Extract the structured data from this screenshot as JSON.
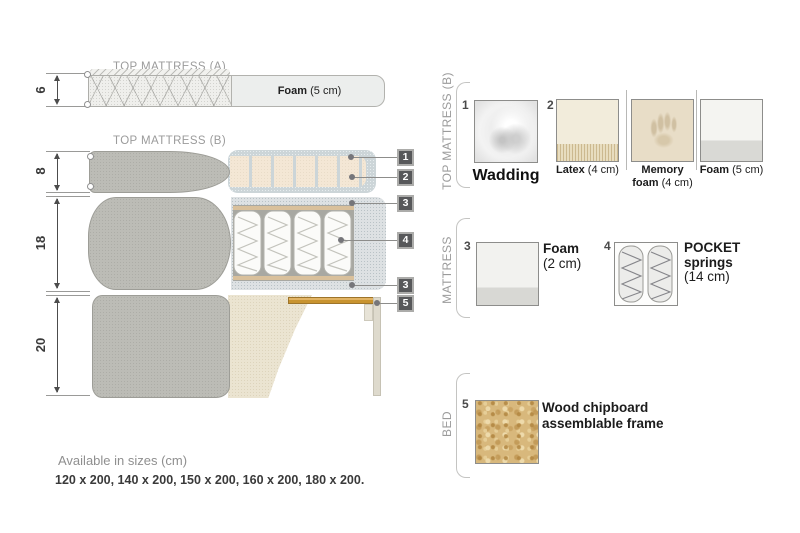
{
  "colors": {
    "gray_fabric": "#bcbcb6",
    "cream_fabric": "#ebe4d1",
    "latex_cream": "#f4e7d5",
    "wadding_blue": "#ccd5d8",
    "foam_speckle": "#dde1e3",
    "wood_slat": "#c8932f",
    "chipboard": "#d8b87c",
    "badge_gray": "#57585a",
    "text_gray": "#9b9b9b",
    "text_dark": "#333333"
  },
  "diagram": {
    "top_mattress_a": {
      "title": "TOP MATTRESS (A)",
      "dim": "6",
      "foam_bold": "Foam",
      "foam_rest": " (5 cm)"
    },
    "top_mattress_b": {
      "title": "TOP MATTRESS (B)",
      "dim": "8"
    },
    "mattress": {
      "dim": "18"
    },
    "bed": {
      "dim": "20"
    },
    "callouts": [
      "1",
      "2",
      "3",
      "4",
      "3",
      "5"
    ]
  },
  "legend": {
    "top_mattress_b": {
      "section_label": "TOP MATTRESS (B)",
      "items": [
        {
          "num": "1",
          "name": "Wadding"
        },
        {
          "num": "2",
          "bold": "Latex",
          "rest": " (4 cm)"
        },
        {
          "bold1": "Memory",
          "bold2": "foam",
          "rest": " (4 cm)"
        },
        {
          "bold": "Foam",
          "rest": " (5 cm)"
        }
      ]
    },
    "mattress": {
      "section_label": "MATTRESS",
      "items": [
        {
          "num": "3",
          "bold": "Foam",
          "rest": "(2 cm)"
        },
        {
          "num": "4",
          "bold1": "POCKET",
          "bold2": "springs",
          "rest": "(14 cm)"
        }
      ]
    },
    "bed": {
      "section_label": "BED",
      "items": [
        {
          "num": "5",
          "line1": "Wood chipboard",
          "line2": "assemblable frame"
        }
      ]
    }
  },
  "footer": {
    "title": "Available in sizes (cm)",
    "sizes": "120 x 200, 140 x 200, 150 x 200, 160 x 200, 180 x 200."
  }
}
